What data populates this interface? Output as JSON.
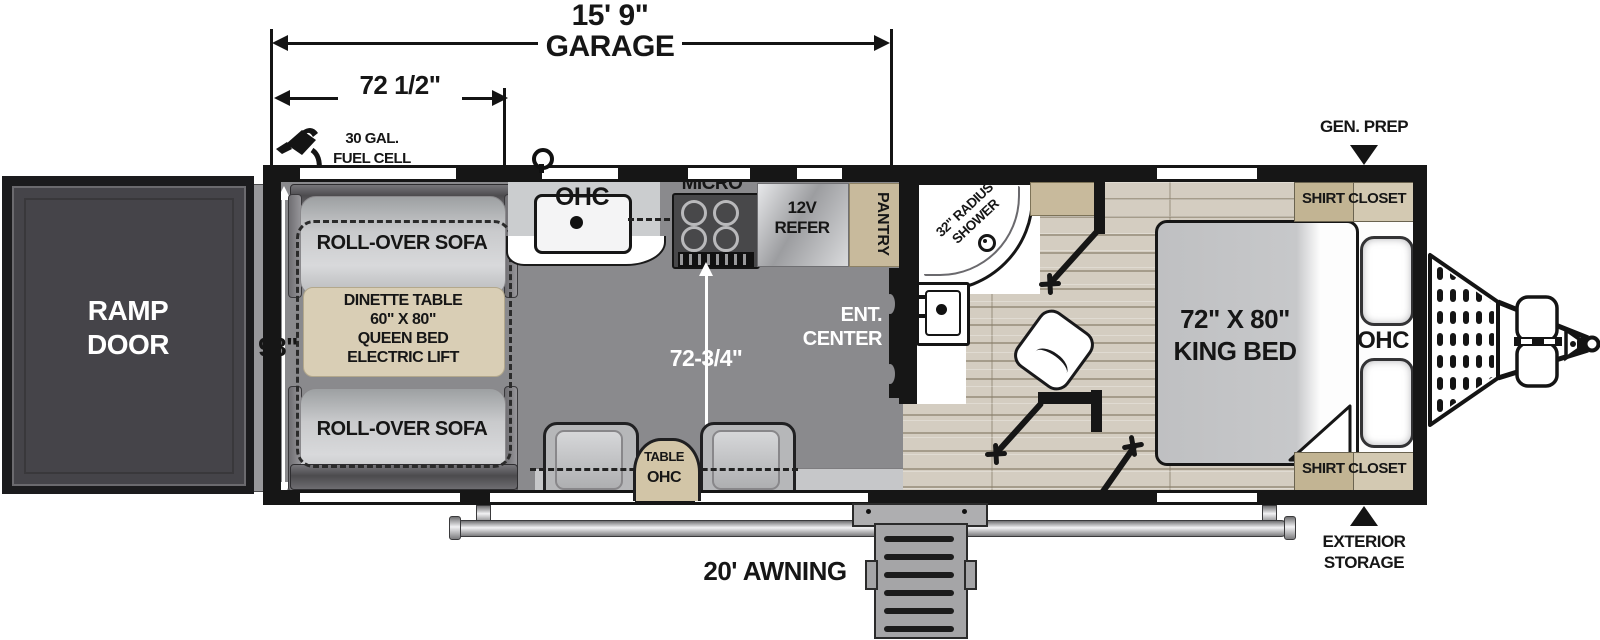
{
  "dims": {
    "garage_length": "15' 9\"",
    "garage_word": "GARAGE",
    "garage_width": "72 1/2\"",
    "body_width": "98\"",
    "living_width": "72-3/4\"",
    "awning": "20' AWNING"
  },
  "exterior": {
    "fuel_line1": "30 GAL.",
    "fuel_line2": "FUEL CELL",
    "gen_prep": "GEN. PREP",
    "storage_line1": "EXTERIOR",
    "storage_line2": "STORAGE"
  },
  "garage": {
    "ramp_line1": "RAMP",
    "ramp_line2": "DOOR",
    "sofa_top": "ROLL-OVER SOFA",
    "sofa_bottom": "ROLL-OVER SOFA",
    "dinette_line1": "DINETTE TABLE",
    "dinette_line2": "60\" X 80\"",
    "dinette_line3": "QUEEN BED",
    "dinette_line4": "ELECTRIC LIFT",
    "table": "TABLE",
    "table_ohc": "OHC"
  },
  "kitchen": {
    "ohc": "OHC",
    "micro": "MICRO",
    "refer_line1": "12V",
    "refer_line2": "REFER",
    "pantry": "PANTRY",
    "ent_line1": "ENT.",
    "ent_line2": "CENTER"
  },
  "bath": {
    "shower_line1": "32\" RADIUS",
    "shower_line2": "SHOWER"
  },
  "bedroom": {
    "bed_line1": "72\" X 80\"",
    "bed_line2": "KING BED",
    "ohc": "OHC",
    "closet_top": "SHIRT CLOSET",
    "closet_bottom": "SHIRT CLOSET"
  },
  "colors": {
    "wall": "#161616",
    "garage_floor": "#8a8a8d",
    "wood_floor": "#d4cdc1",
    "cabinet_tan": "#c8ba9c",
    "dinette_tan": "#d9ceb5",
    "sofa_gray": "#c7c8ca",
    "ramp_door": "#454449",
    "fixture_white": "#ffffff"
  }
}
